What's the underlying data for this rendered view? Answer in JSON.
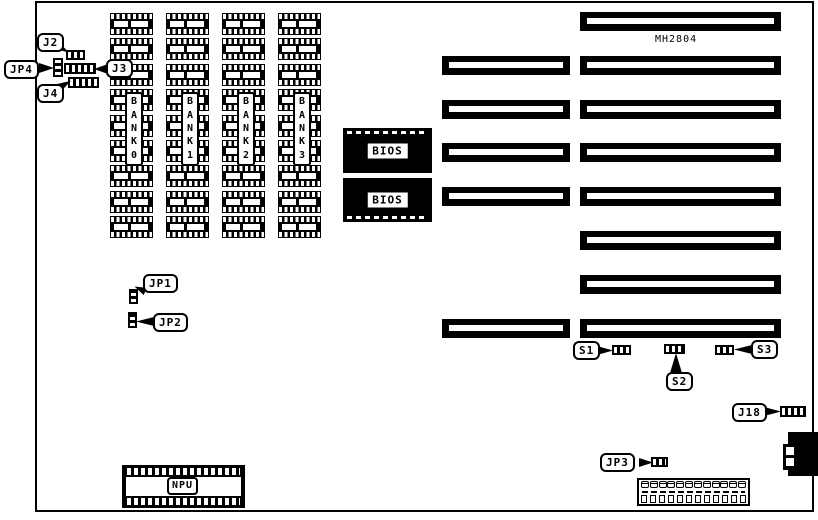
{
  "board": {
    "chip_label": "MH2804",
    "npu_label": "NPU",
    "bios_labels": [
      "BIOS",
      "BIOS"
    ],
    "banks": [
      "BANK0",
      "BANK1",
      "BANK2",
      "BANK3"
    ],
    "callouts": {
      "j2": "J2",
      "jp4": "JP4",
      "j3": "J3",
      "j4": "J4",
      "jp1": "JP1",
      "jp2": "JP2",
      "jp3": "JP3",
      "s1": "S1",
      "s2": "S2",
      "s3": "S3",
      "j18": "J18"
    },
    "memory": {
      "columns": 4,
      "chips_per_column": 9
    },
    "slots": [
      {
        "row": 1,
        "has_left_segment": false
      },
      {
        "row": 2,
        "has_left_segment": true
      },
      {
        "row": 3,
        "has_left_segment": true
      },
      {
        "row": 4,
        "has_left_segment": true
      },
      {
        "row": 5,
        "has_left_segment": true
      },
      {
        "row": 6,
        "has_left_segment": false
      },
      {
        "row": 7,
        "has_left_segment": false
      },
      {
        "row": 8,
        "has_left_segment": true
      }
    ],
    "power_connector": {
      "pins": 12
    }
  }
}
